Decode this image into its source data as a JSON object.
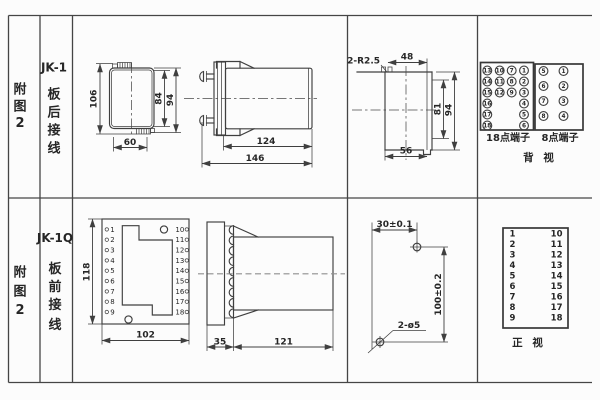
{
  "colors": {
    "bg": "#fcfcfc",
    "line": "#3f3f3f",
    "text": "#262626"
  },
  "row1": {
    "index": [
      "附",
      "图",
      "2"
    ],
    "model": "JK-1",
    "wiring": [
      "板",
      "后",
      "接",
      "线"
    ],
    "rear": {
      "height": "106",
      "inner": "84",
      "outer": "94",
      "width": "60"
    },
    "side": {
      "body": "124",
      "total": "146"
    },
    "cutout": {
      "radius": "2-R2.5",
      "top": "48",
      "inner": "81",
      "outer": "94",
      "bottom": "56"
    },
    "back": {
      "t18_label": "18点端子",
      "t8_label": "8点端子",
      "view": "背 视",
      "c1": [
        "13",
        "14",
        "15",
        "16",
        "17",
        "18"
      ],
      "c2": [
        "10",
        "11",
        "12"
      ],
      "c3": [
        "7",
        "8",
        "9"
      ],
      "c4": [
        "1",
        "2",
        "3",
        "4",
        "5",
        "6"
      ],
      "e_left": [
        "5",
        "6",
        "7",
        "8"
      ],
      "e_right": [
        "1",
        "2",
        "3",
        "4"
      ]
    }
  },
  "row2": {
    "index": [
      "附",
      "图",
      "2"
    ],
    "model": "JK-1Q",
    "wiring": [
      "板",
      "前",
      "接",
      "线"
    ],
    "front": {
      "height": "118",
      "width": "102",
      "left": [
        "1",
        "2",
        "3",
        "4",
        "5",
        "6",
        "7",
        "8",
        "9"
      ],
      "right": [
        "10",
        "11",
        "12",
        "13",
        "14",
        "15",
        "16",
        "17",
        "18"
      ]
    },
    "side": {
      "flange": "35",
      "body": "121"
    },
    "holes": {
      "horizontal": "30±0.1",
      "vertical": "100±0.2",
      "label": "2-ø5"
    },
    "panel": {
      "view": "正 视",
      "left": [
        "1",
        "2",
        "3",
        "4",
        "5",
        "6",
        "7",
        "8",
        "9"
      ],
      "right": [
        "10",
        "11",
        "12",
        "13",
        "14",
        "15",
        "16",
        "17",
        "18"
      ]
    }
  }
}
